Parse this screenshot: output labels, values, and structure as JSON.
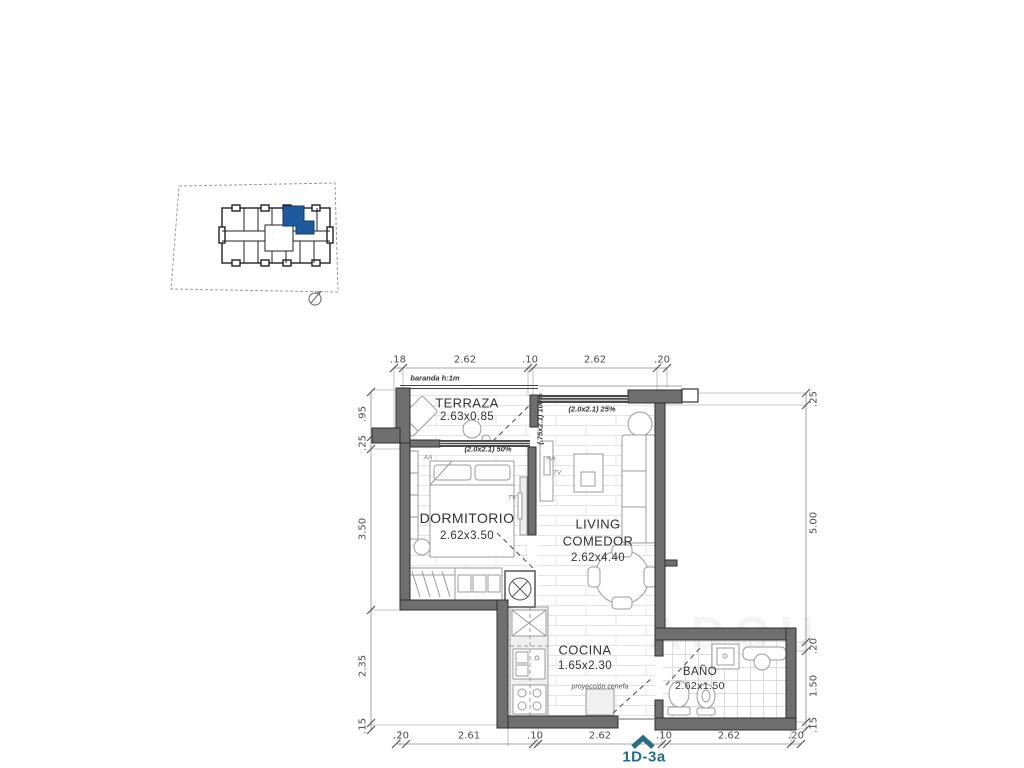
{
  "key_plan": {
    "description": "building footprint with highlighted unit",
    "highlight_color": "#1d5b9e"
  },
  "plan": {
    "rooms": {
      "terraza": {
        "name": "TERRAZA",
        "dims": "2.63x0.85"
      },
      "dormitorio": {
        "name": "DORMITORIO",
        "dims": "2.62x3.50"
      },
      "living": {
        "name_line1": "LIVING",
        "name_line2": "COMEDOR",
        "dims": "2.62x4.40"
      },
      "cocina": {
        "name": "COCINA",
        "dims": "1.65x2.30"
      },
      "bano": {
        "name": "BAÑO",
        "dims": "2.62x1.50"
      }
    },
    "annotations": {
      "baranda": "baranda h:1m",
      "window_dorm": "(2.0x2.1) 50%",
      "window_living": "(2.0x2.1) 25%",
      "door_terraza": "(.75x2.1) 100%",
      "cenefa": "proyección cenefa",
      "ac_dorm": "AA",
      "tv_dorm": "TV",
      "ac_living": "AA",
      "tv_living": "TV"
    },
    "dimensions": {
      "top": [
        ".18",
        "2.62",
        ".10",
        "2.62",
        ".20"
      ],
      "bottom": [
        ".20",
        "2.61",
        ".10",
        "2.62",
        ".10",
        "2.62",
        ".20"
      ],
      "left": [
        ".95",
        ".25",
        "3.50",
        "2.35",
        ".15"
      ],
      "right": [
        ".25",
        "5.00",
        ".20",
        "1.50",
        ".15"
      ]
    },
    "unit_label": "1D-3a",
    "colors": {
      "unit_label": "#256e86",
      "walls": "#6f6f6f"
    }
  },
  "watermark": "ADQU"
}
